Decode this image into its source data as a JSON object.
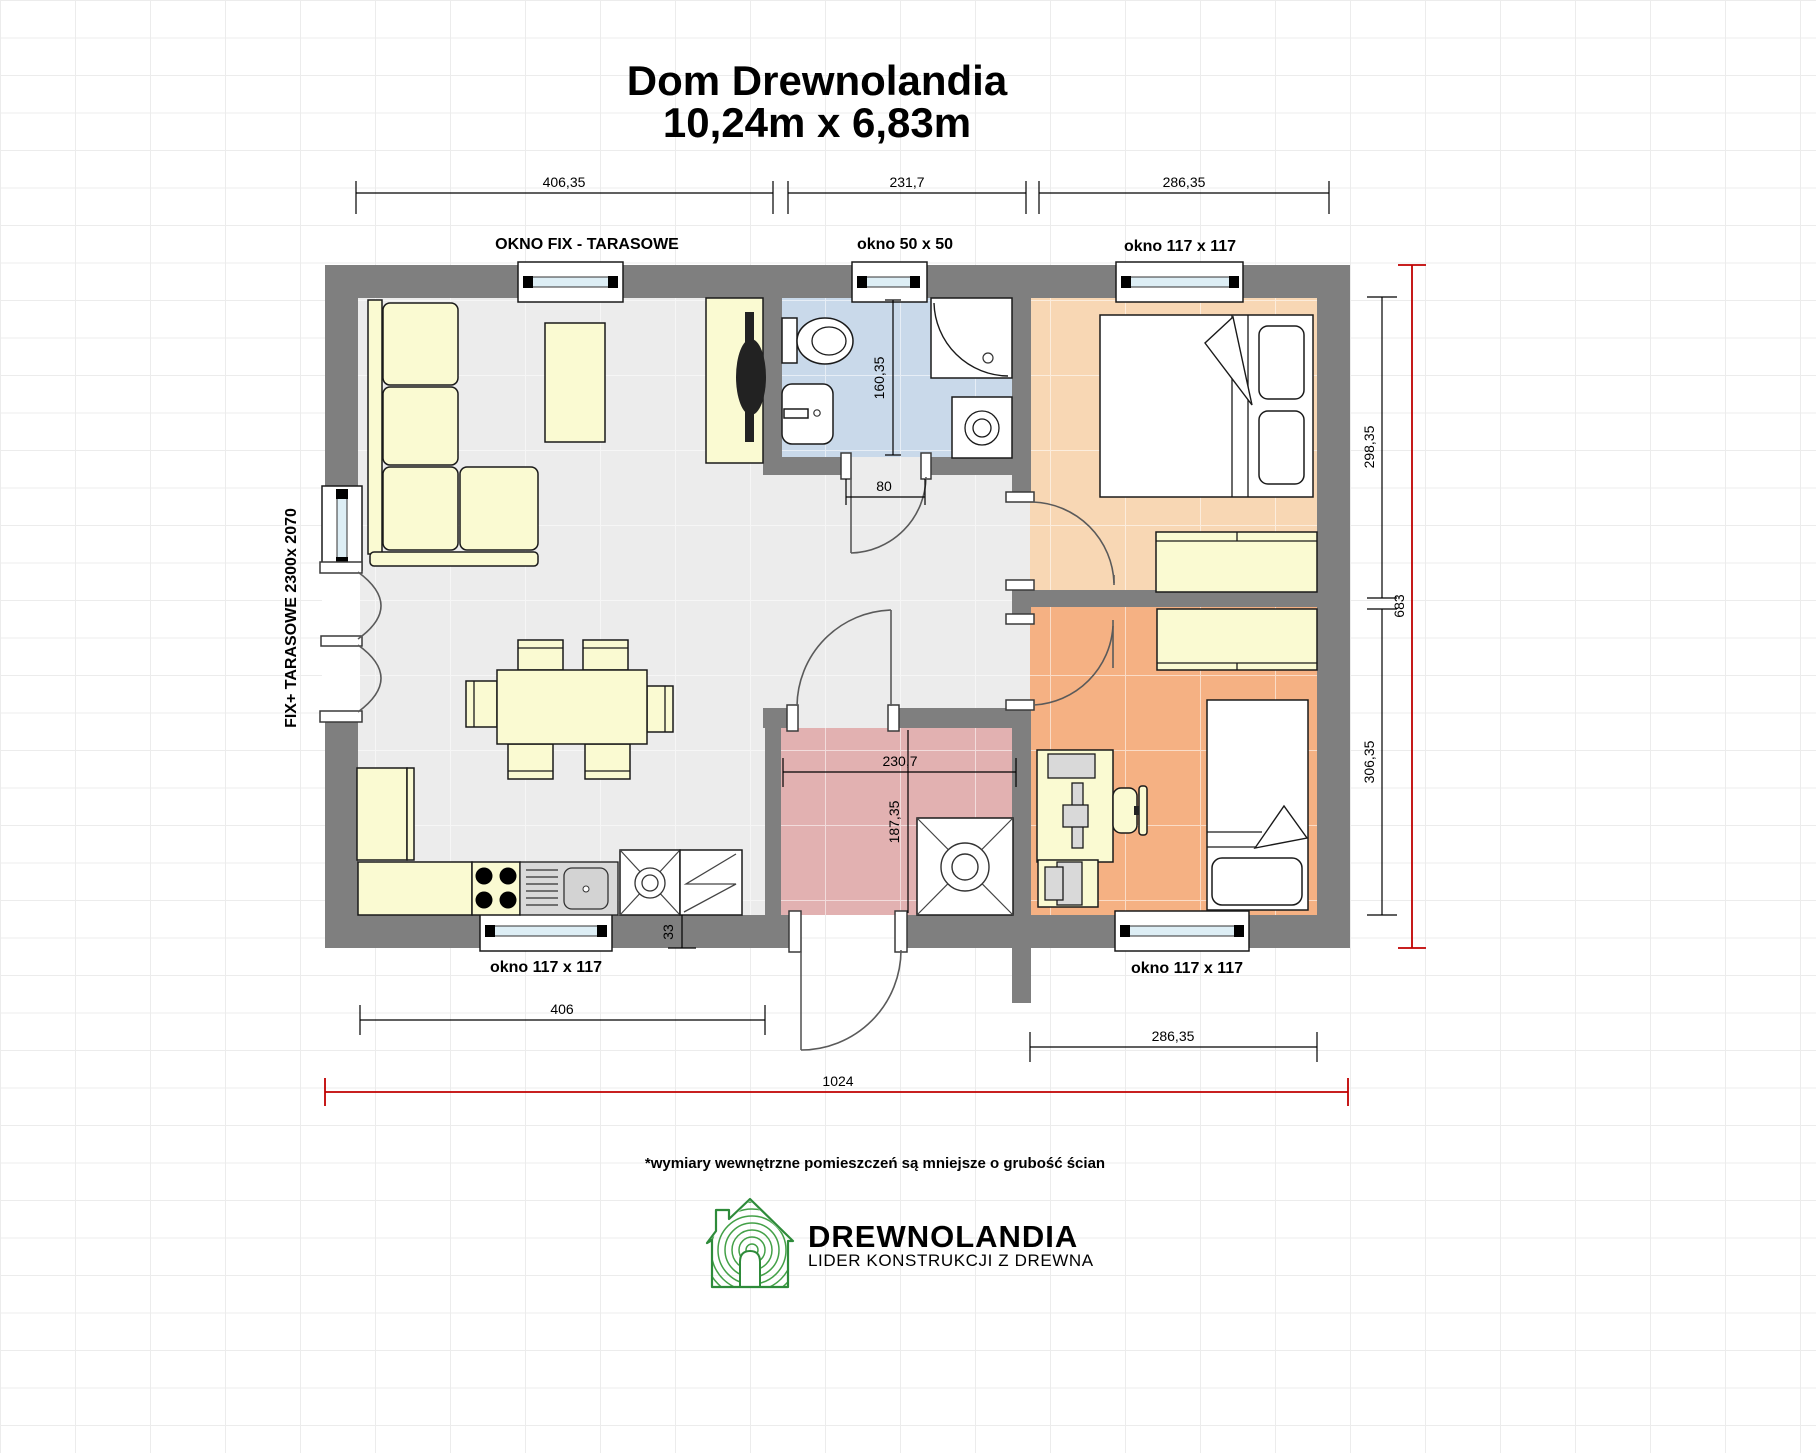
{
  "title": {
    "line1": "Dom Drewnolandia",
    "line2": "10,24m x 6,83m"
  },
  "dimensions": {
    "top": [
      {
        "value": "406,35",
        "label": "OKNO FIX - TARASOWE"
      },
      {
        "value": "231,7",
        "label": "okno 50 x 50"
      },
      {
        "value": "286,35",
        "label": "okno 117 x 117"
      }
    ],
    "left_wall_label": "FIX+ TARASOWE 2300x 2070",
    "right": {
      "upper_room": "298,35",
      "lower_room": "306,35",
      "total_height": "683"
    },
    "bottom": {
      "left_window_label": "okno 117 x 117",
      "living_width": "406",
      "wall_thickness": "33",
      "right_window_label": "okno 117 x 117",
      "bedroom_width": "286,35",
      "total_width": "1024"
    },
    "interior": {
      "bathroom_depth": "160,35",
      "bathroom_door_width": "80",
      "hall_width": "230,7",
      "hall_depth": "187,35"
    }
  },
  "footnote": "*wymiary wewnętrzne pomieszczeń są mniejsze o grubość ścian",
  "logo": {
    "name": "DREWNOLANDIA",
    "tagline": "LIDER KONSTRUKCJI Z DREWNA"
  },
  "colors": {
    "wall": "#7f7f7f",
    "floor": "#ececec",
    "bathroom": "#c9d9ea",
    "hallway": "#e2b1b1",
    "bedroom_top": "#f8d7b4",
    "bedroom_bottom": "#f5b183",
    "furniture": "#fafad2",
    "window_glass": "#ddeef5",
    "dimension_red": "#c00000",
    "logo_green": "#2e7d32",
    "logo_green_light": "#47a04b"
  }
}
